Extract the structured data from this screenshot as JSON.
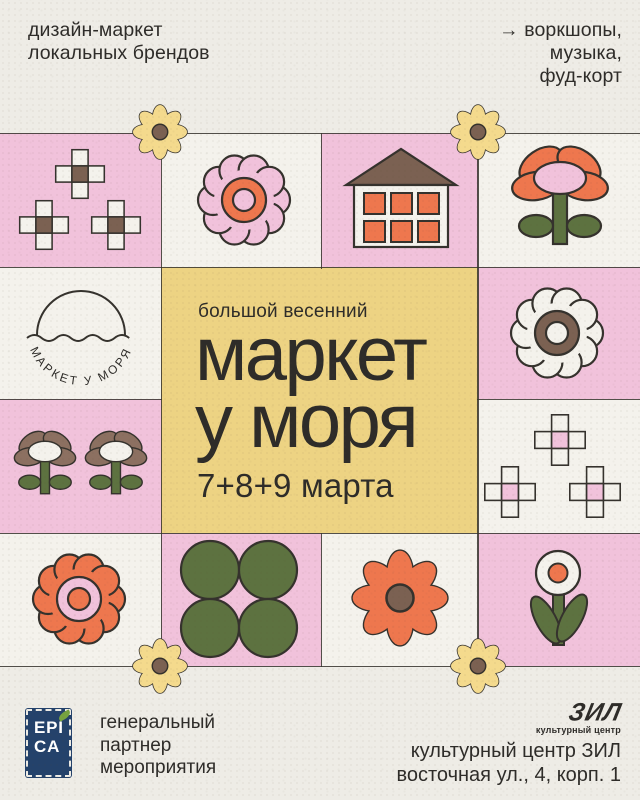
{
  "poster": {
    "tagline_left": "дизайн-маркет\nлокальных брендов",
    "tagline_right": "→ воркшопы,\nмузыка,\nфуд-корт",
    "kicker": "большой весенний",
    "title": "маркет\nу моря",
    "dates": "7+8+9 марта",
    "logo_arc_text": "МАРКЕТ У МОРЯ"
  },
  "footer": {
    "epica_logo_line1": "EPI",
    "epica_logo_line2": "CA",
    "partner_text": "генеральный\nпартнер\nмероприятия",
    "zil_logo_text": "ЗИЛ",
    "zil_logo_subtext": "культурный центр",
    "address_line1": "культурный центр ЗИЛ",
    "address_line2": "восточная ул., 4, корп. 1"
  },
  "icons": {
    "daisy_flower": "daisy-flower-icon",
    "ring_flower": "ring-flower-icon",
    "plus_squares": "plus-squares-icon",
    "house": "house-icon",
    "oval_petal_flower": "oval-petal-flower-icon",
    "four_dots": "four-dots-icon",
    "stem_flower": "stem-flower-icon",
    "arc_logo": "market-u-morya-logo-icon",
    "leaf": "leaf-icon"
  },
  "colors": {
    "paper": "#eeece6",
    "cream": "#f4f2ec",
    "pink": "#f1c2db",
    "yellow": "#edd383",
    "petalyellow": "#f4da8d",
    "orange": "#ee774e",
    "brown": "#7b6152",
    "mauve": "#8c7061",
    "green": "#5d7240",
    "navy": "#24426b",
    "leaf": "#76a33f",
    "ink": "#2e2c29",
    "line": "#35322d"
  }
}
